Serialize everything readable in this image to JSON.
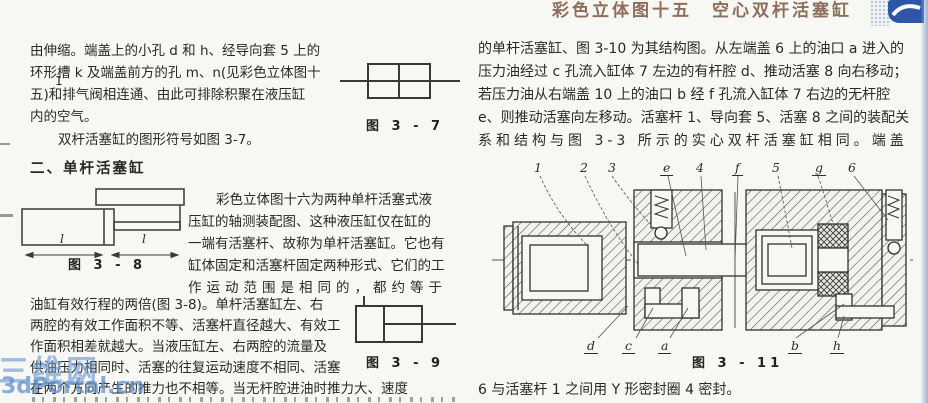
{
  "page": {
    "header_title": "彩色立体图十五　空心双杆活塞缸",
    "top_left_mark": "1",
    "watermark_cn": "三维网",
    "watermark_en": "3dPortal.cn",
    "colors": {
      "header_brown": "#8f6e59",
      "logo_blue": "#2d55a8",
      "watermark_blue": "#6998d2",
      "edge_strip_blue": "#9db3cf",
      "ink": "#2a2a24"
    }
  },
  "left": {
    "p1_lines": [
      "由伸缩。端盖上的小孔 d 和 h、经导向套 5 上的",
      "环形槽 k 及端盖前方的孔 m、n(见彩色立体图十",
      "五)和排气阀相连通、由此可排除积聚在液压缸",
      "内的空气。"
    ],
    "p2": "双杆活塞缸的图形符号如图 3-7。",
    "heading": "二、单杆活塞缸",
    "p3_lines": [
      "彩色立体图十六为两种单杆活塞式液",
      "压缸的轴测装配图、这种液压缸仅在缸的",
      "一端有活塞杆、故称为单杆活塞缸。它也有",
      "缸体固定和活塞杆固定两种形式、它们的工",
      "作运动范围是相同的，都约等于"
    ],
    "p4_lines": [
      "油缸有效行程的两倍(图 3-8)。单杆活塞缸左、右",
      "两腔的有效工作面积不等、活塞杆直径越大、有效工",
      "作面积相差就越大。当液压缸左、右两腔的流量及",
      "供油压力相同时、活塞的往复运动速度不相同、活塞",
      "在两个方向产生的推力也不相等。当无杆腔进油时推力大、速度"
    ],
    "fig7_caption": "图 3 - 7",
    "fig8_caption": "图 3 - 8",
    "fig8_dim_label_left": "l",
    "fig8_dim_label_right": "l",
    "fig9_caption": "图 3 - 9"
  },
  "right": {
    "para_lines": [
      "的单杆活塞缸、图 3-10 为其结构图。从左端盖 6 上的油口 a 进入的",
      "压力油经过 c 孔流入缸体 7 左边的有杆腔 d、推动活塞 8 向右移动；",
      "若压力油从右端盖 10 上的油口 b 经 f 孔流入缸体 7 右边的无杆腔",
      "e、则推动活塞向左移动。活塞杆 1、导向套 5、活塞 8 之间的装配关",
      "系和结构与图 3-3 所示的实心双杆活塞缸相同。端盖"
    ],
    "fig11": {
      "caption": "图 3 - 11",
      "labels_top": [
        "1",
        "2",
        "3",
        "e",
        "4",
        "f",
        "5",
        "g",
        "6"
      ],
      "labels_bottom": [
        "d",
        "c",
        "a",
        "b",
        "h"
      ]
    },
    "bottom_line": "6 与活塞杆 1 之间用 Y 形密封圈 4 密封。"
  }
}
